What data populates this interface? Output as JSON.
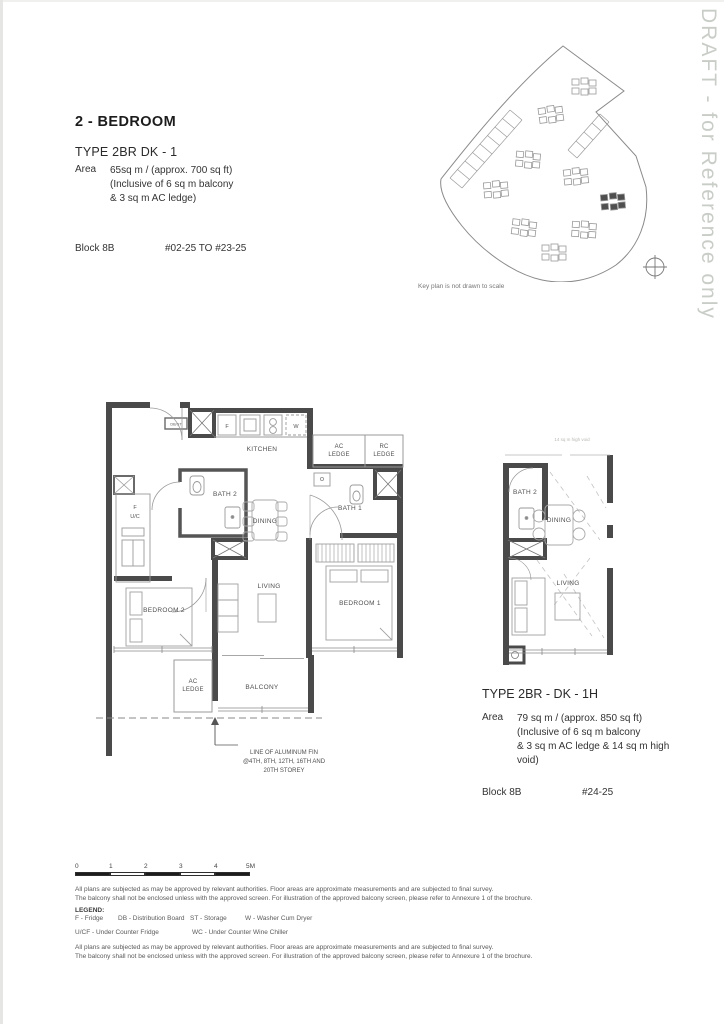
{
  "watermark": "DRAFT - for Reference only",
  "unit1": {
    "category": "2 - BEDROOM",
    "title": "TYPE 2BR DK - 1",
    "area_label": "Area",
    "area_lines": [
      "65sq m / (approx. 700 sq ft)",
      "(Inclusive of 6 sq m balcony",
      "& 3 sq m AC ledge)"
    ],
    "block_label": "Block 8B",
    "unit_range": "#02-25 TO #23-25"
  },
  "unit2": {
    "title": "TYPE 2BR - DK - 1H",
    "area_label": "Area",
    "area_lines": [
      "79 sq m / (approx. 850 sq ft)",
      "(Inclusive of 6 sq m balcony",
      "& 3 sq m AC ledge & 14 sq m high",
      "void)"
    ],
    "block_label": "Block 8B",
    "unit_range": "#24-25"
  },
  "keyplan": {
    "caption": "Key plan is not drawn to scale"
  },
  "plan1": {
    "rooms": {
      "kitchen": "KITCHEN",
      "bath1": "BATH 1",
      "bath2": "BATH 2",
      "dining": "DINING",
      "living": "LIVING",
      "bedroom1": "BEDROOM 1",
      "bedroom2": "BEDROOM 2",
      "balcony": "BALCONY"
    },
    "ledges": {
      "ac_top_1": "AC",
      "ac_top_2": "LEDGE",
      "rc_1": "RC",
      "rc_2": "LEDGE",
      "ac_bot_1": "AC",
      "ac_bot_2": "LEDGE"
    },
    "fixtures": {
      "fridge": "F",
      "washer": "W",
      "db_st": "DB/ST",
      "f": "F",
      "uc": "U/C"
    },
    "annotation": [
      "LINE OF ALUMINUM FIN",
      "@4TH, 8TH, 12TH, 16TH AND",
      "20TH STOREY"
    ]
  },
  "plan2": {
    "rooms": {
      "bath2": "BATH 2",
      "dining": "DINING",
      "living": "LIVING"
    },
    "void_note": "14 sq m high void"
  },
  "scalebar": {
    "ticks": [
      "0",
      "1",
      "2",
      "3",
      "4",
      "5M"
    ]
  },
  "footer": {
    "disclaimer_line1": "All plans are subjected as may be approved by relevant authorities. Floor areas are approximate measurements and are subjected to final survey.",
    "disclaimer_line2": "The balcony shall not be enclosed unless with the approved screen. For illustration of the approved balcony screen, please refer to Annexure 1 of the brochure.",
    "legend_label": "LEGEND:",
    "legend_row1": [
      "F - Fridge",
      "DB - Distribution Board",
      "ST - Storage",
      "W - Washer Cum Dryer"
    ],
    "legend_row2": [
      "U/CF - Under Counter Fridge",
      "WC - Under Counter Wine Chiller"
    ]
  }
}
